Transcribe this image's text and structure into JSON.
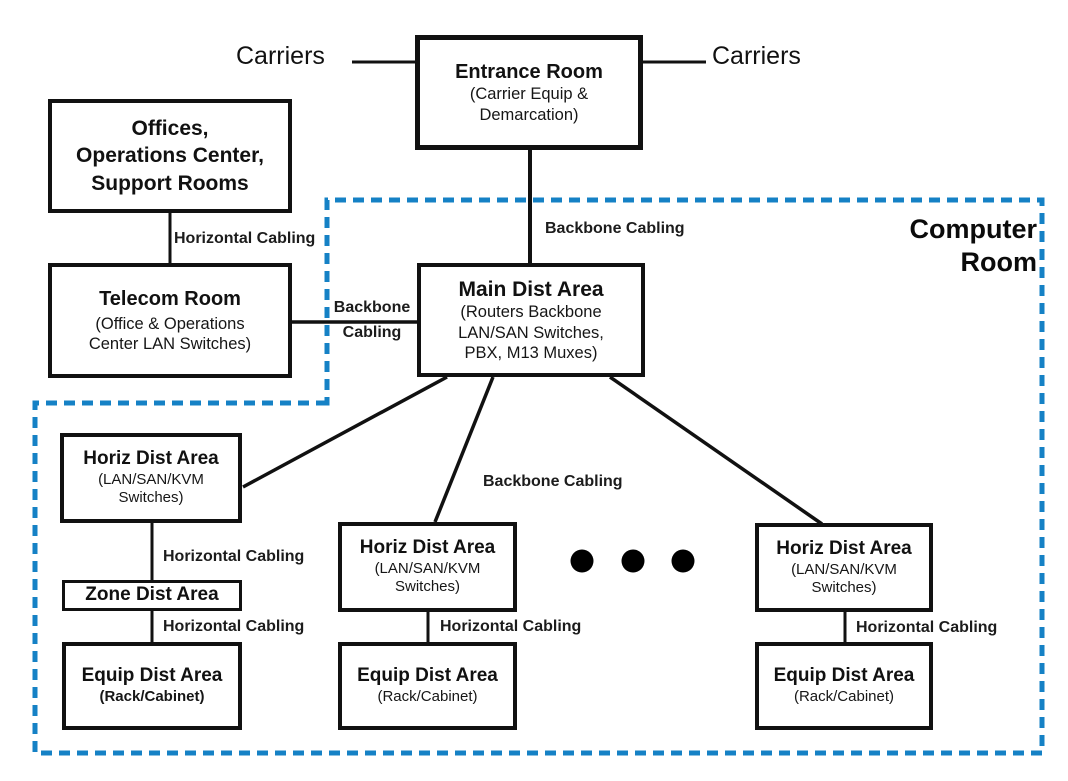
{
  "diagram": {
    "region_label": {
      "line1": "Computer",
      "line2": "Room"
    },
    "external_labels": {
      "carriers_left": "Carriers",
      "carriers_right": "Carriers"
    },
    "edge_labels": {
      "horizontal_cabling": "Horizontal Cabling",
      "backbone_cabling": "Backbone Cabling",
      "backbone_line1": "Backbone",
      "backbone_line2": "Cabling"
    },
    "nodes": {
      "entrance_room": {
        "title": "Entrance Room",
        "sub1": "(Carrier Equip &",
        "sub2": "Demarcation)"
      },
      "offices": {
        "line1": "Offices,",
        "line2": "Operations Center,",
        "line3": "Support Rooms"
      },
      "telecom_room": {
        "title": "Telecom Room",
        "sub1": "(Office & Operations",
        "sub2": "Center LAN Switches)"
      },
      "main_dist_area": {
        "title": "Main Dist Area",
        "sub1": "(Routers Backbone",
        "sub2": "LAN/SAN Switches,",
        "sub3": "PBX, M13 Muxes)"
      },
      "horiz_dist_left": {
        "title": "Horiz Dist Area",
        "sub1": "(LAN/SAN/KVM",
        "sub2": "Switches)"
      },
      "horiz_dist_mid": {
        "title": "Horiz Dist Area",
        "sub1": "(LAN/SAN/KVM",
        "sub2": "Switches)"
      },
      "horiz_dist_right": {
        "title": "Horiz Dist Area",
        "sub1": "(LAN/SAN/KVM",
        "sub2": "Switches)"
      },
      "zone_dist": {
        "title": "Zone Dist Area"
      },
      "equip_dist_left": {
        "title": "Equip Dist Area",
        "sub1": "(Rack/Cabinet)"
      },
      "equip_dist_mid": {
        "title": "Equip Dist Area",
        "sub1": "(Rack/Cabinet)"
      },
      "equip_dist_right": {
        "title": "Equip Dist Area",
        "sub1": "(Rack/Cabinet)"
      }
    },
    "ellipsis_dot_count": 3,
    "colors": {
      "boundary_blue": "#1581c5",
      "line_black": "#111111",
      "box_background": "#ffffff"
    }
  }
}
